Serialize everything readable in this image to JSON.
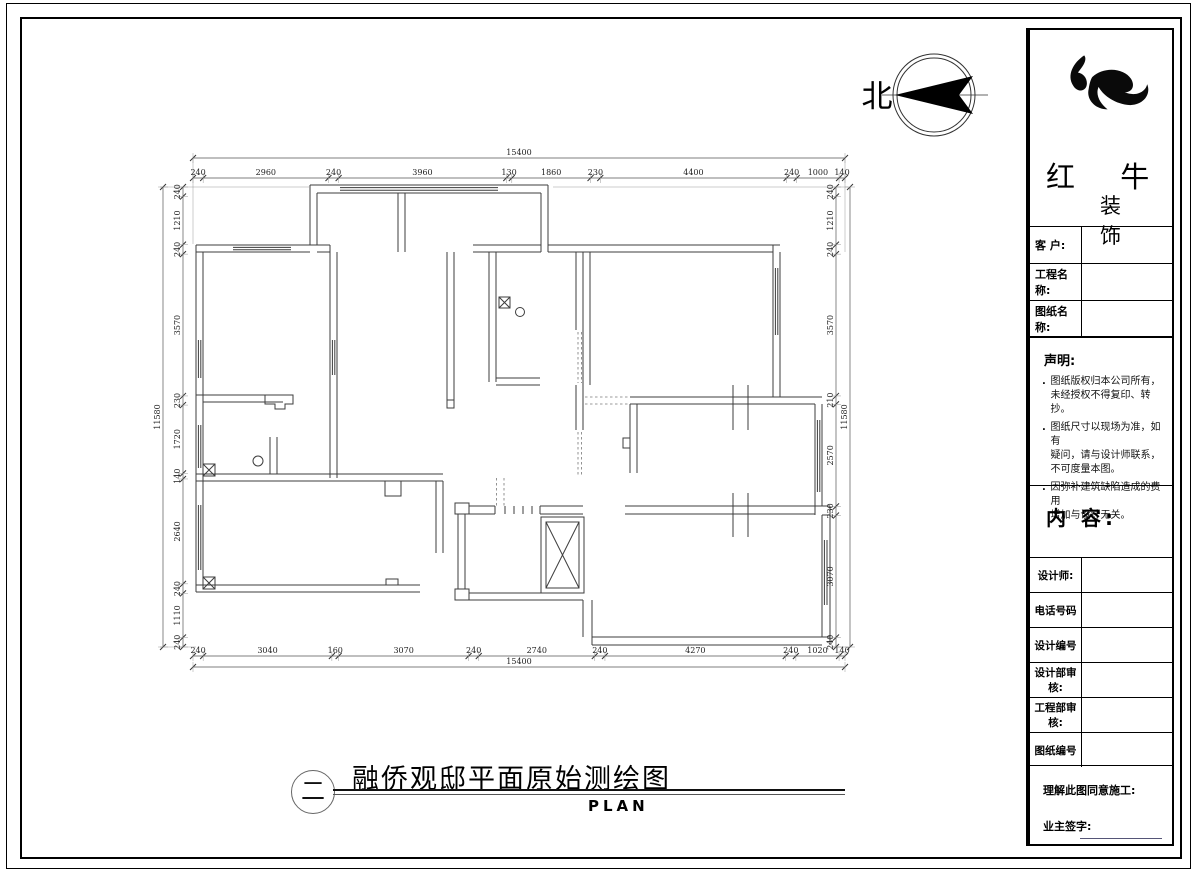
{
  "compass": {
    "label": "北"
  },
  "plan_title": {
    "index_symbol": "二",
    "title": "融侨观邸平面原始测绘图",
    "subtitle": "PLAN"
  },
  "dimensions": {
    "top": {
      "total": 15400,
      "segments": [
        240,
        2960,
        240,
        3960,
        130,
        1860,
        230,
        4400,
        240,
        1000,
        140
      ]
    },
    "bottom": {
      "total": 15400,
      "segments": [
        240,
        3040,
        160,
        3070,
        240,
        2740,
        240,
        4270,
        240,
        1020,
        140
      ]
    },
    "left": {
      "total": 11580,
      "segments": [
        240,
        1210,
        240,
        3570,
        230,
        1720,
        140,
        2640,
        240,
        1110,
        240
      ]
    },
    "right": {
      "total": 11580,
      "segments": [
        240,
        1210,
        240,
        3570,
        210,
        2570,
        230,
        3070,
        240
      ]
    }
  },
  "title_block": {
    "brand": {
      "name": "红 牛",
      "sub": "装 饰"
    },
    "fields": [
      {
        "label": "客 户:"
      },
      {
        "label": "工程名称:"
      },
      {
        "label": "图纸名称:"
      }
    ],
    "statement": {
      "heading": "声明:",
      "items": [
        [
          "图纸版权归本公司所有，",
          "未经授权不得复印、转抄。"
        ],
        [
          "图纸尺寸以现场为准，如有",
          "疑问，请与设计师联系，",
          "不可度量本图。"
        ],
        [
          "因弥补建筑缺陷造成的费用",
          "增加与设计无关。"
        ]
      ]
    },
    "content_label": "内 容:",
    "rows": [
      {
        "label": "设计师:"
      },
      {
        "label": "电话号码"
      },
      {
        "label": "设计编号"
      },
      {
        "label": "设计部审核:"
      },
      {
        "label": "工程部审核:"
      },
      {
        "label": "图纸编号"
      }
    ],
    "footer": {
      "agree": "理解此图同意施工:",
      "sign": "业主签字:"
    }
  }
}
